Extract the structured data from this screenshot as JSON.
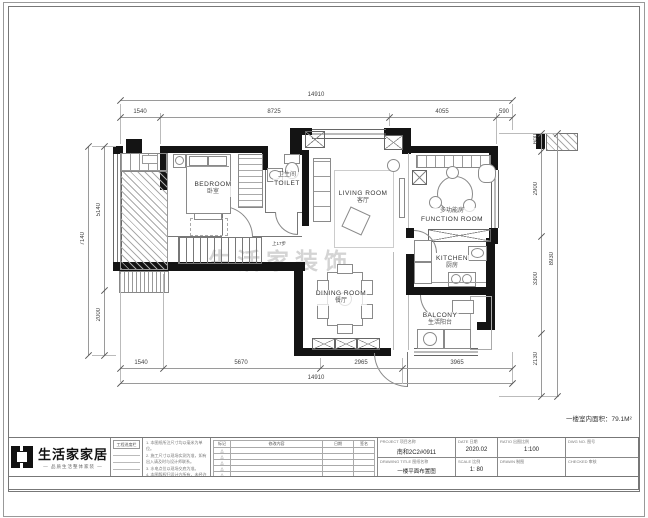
{
  "sheet": {
    "area_note": "一楼室内面积：79.1M²",
    "watermark": "生活家装饰",
    "stair_note": "上17步"
  },
  "rooms": [
    {
      "en": "BEDROOM",
      "zh": "卧室"
    },
    {
      "en": "TOILET",
      "zh": "卫生间"
    },
    {
      "en": "LIVING ROOM",
      "zh": "客厅"
    },
    {
      "en": "FUNCTION ROOM",
      "zh": "多功能房"
    },
    {
      "en": "KITCHEN",
      "zh": "厨房"
    },
    {
      "en": "DINING ROOM",
      "zh": "餐厅"
    },
    {
      "en": "BALCONY",
      "zh": "生活阳台"
    }
  ],
  "dimensions": {
    "top": {
      "overall": "14910",
      "segments": [
        "1540",
        "8725",
        "4055",
        "590"
      ]
    },
    "bottom": {
      "overall": "14910",
      "segments": [
        "1540",
        "5670",
        "2965",
        "3965"
      ]
    },
    "left": {
      "overall": "7140",
      "segments": [
        "5140",
        "2000"
      ]
    },
    "right": {
      "overall": "8930",
      "segments": [
        "600",
        "2900",
        "3300",
        "2130"
      ]
    }
  },
  "brand": {
    "name": "生活家家居",
    "tagline": "— 品质生活整体家装 —"
  },
  "titleblock": {
    "progress_header": "工程进度栏",
    "notes": [
      "1. 本图纸所注尺寸均以毫米为单位。",
      "2. 施工尺寸以现场实测为准，如有出入请及时与设计师联系。",
      "3. 水电点位以现场交底为准。",
      "4. 本图版权归设计方所有，未经许可不得翻印。"
    ],
    "revision": {
      "headers": [
        "标记",
        "修改内容",
        "日期",
        "签名"
      ],
      "marks": [
        "△",
        "△",
        "△",
        "△",
        "△"
      ]
    },
    "project": {
      "label": "PROJECT  项目名称",
      "value": "南和2C2#0911"
    },
    "drawing": {
      "label": "DRAWING TITLE  图纸名称",
      "value": "一楼平面布置图"
    },
    "fields": [
      {
        "label": "DATE 日期",
        "value": "2020.02"
      },
      {
        "label": "SCALE 比例",
        "value": "1: 80"
      },
      {
        "label": "RATIO 出图比例",
        "value": "1:100"
      },
      {
        "label": "DRAWN 制图",
        "value": ""
      },
      {
        "label": "DWG NO. 图号",
        "value": ""
      },
      {
        "label": "CHECKED 审核",
        "value": ""
      }
    ]
  }
}
